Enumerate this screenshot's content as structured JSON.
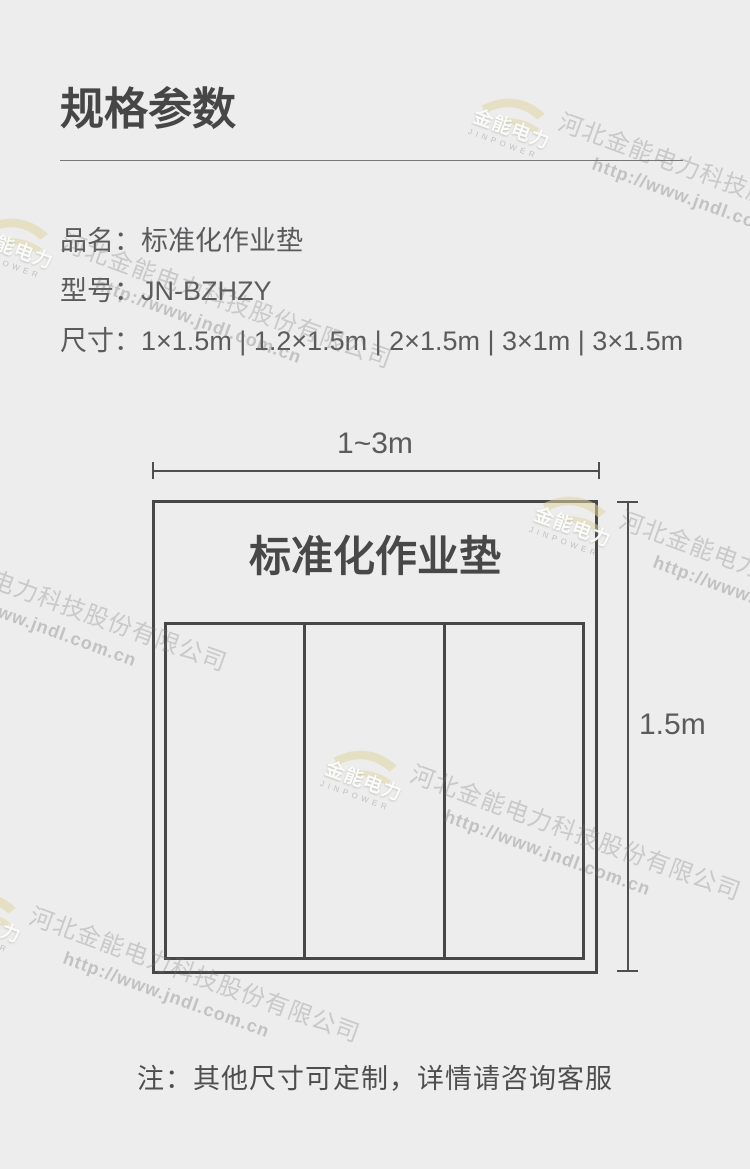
{
  "page": {
    "background": "#ededed"
  },
  "header": {
    "title": "规格参数"
  },
  "specs": {
    "rows": [
      {
        "label": "品名：",
        "value": "标准化作业垫"
      },
      {
        "label": "型号：",
        "value": "JN-BZHZY"
      },
      {
        "label": "尺寸：",
        "value": "1×1.5m | 1.2×1.5m | 2×1.5m | 3×1m | 3×1.5m"
      }
    ]
  },
  "diagram": {
    "width_label": "1~3m",
    "height_label": "1.5m",
    "mat_label": "标准化作业垫",
    "columns": 3,
    "line_color": "#4a4a4a"
  },
  "note": {
    "text": "注：其他尺寸可定制，详情请咨询客服"
  },
  "watermark": {
    "logo_cn": "金能电力",
    "logo_en": "JINPOWER",
    "company": "河北金能电力科技股份有限公司",
    "url": "http://www.jndl.com.cn",
    "text_color": "#d3d3d3",
    "swoosh_color": "#e8e2c4"
  },
  "colors": {
    "title_text": "#464646",
    "body_text": "#5b5b5d",
    "note_text": "#4e4e4e"
  }
}
